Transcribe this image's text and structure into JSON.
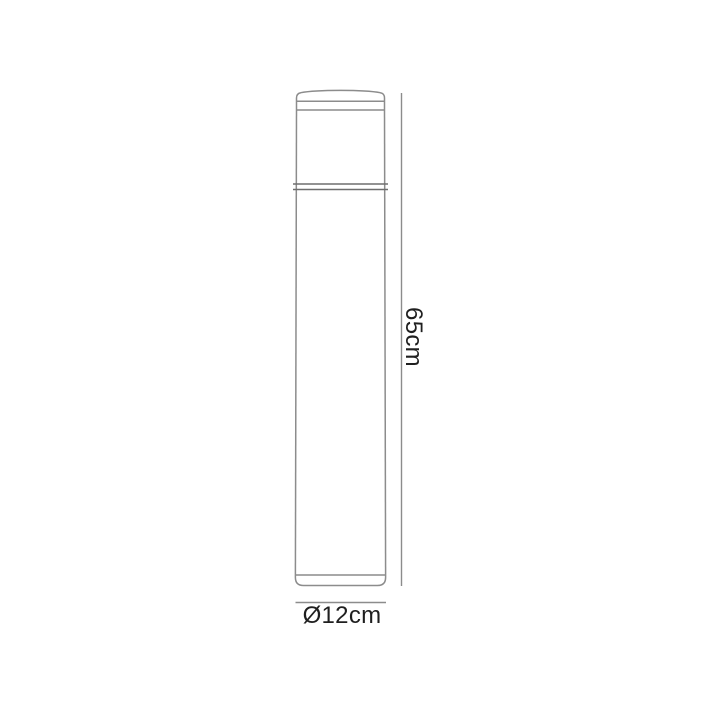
{
  "diagram": {
    "type": "product-dimension-drawing",
    "labels": {
      "height": "65cm",
      "diameter": "Ø12cm"
    },
    "colors": {
      "background": "#ffffff",
      "outline": "#8c8c8c",
      "collar_line": "#6e6e6e",
      "dimension_line": "#8c8c8c",
      "label_text": "#1f1f1f"
    }
  }
}
